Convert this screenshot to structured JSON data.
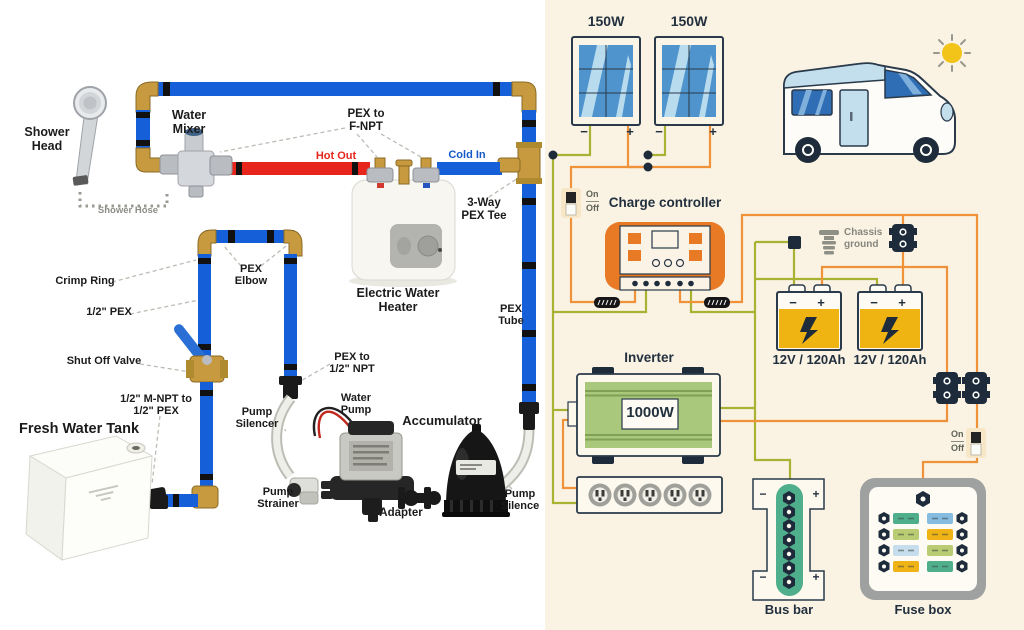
{
  "left": {
    "labels": {
      "shower_head": [
        "Shower",
        "Head"
      ],
      "water_mixer": [
        "Water",
        "Mixer"
      ],
      "shower_hose": "Shower Hose",
      "pex_to_f_npt": [
        "PEX to",
        "F-NPT"
      ],
      "hot_out": "Hot Out",
      "cold_in": "Cold In",
      "three_way_pex_tee": [
        "3-Way",
        "PEX Tee"
      ],
      "crimp_ring": "Crimp Ring",
      "pex_elbow": [
        "PEX",
        "Elbow"
      ],
      "half_inch_pex": "1/2\" PEX",
      "shut_off_valve": "Shut Off Valve",
      "electric_water_heater": [
        "Electric Water",
        "Heater"
      ],
      "pex_tube": [
        "PEX",
        "Tube"
      ],
      "pex_to_half_npt": [
        "PEX to",
        "1/2\" NPT"
      ],
      "m_npt_to_pex": [
        "1/2\" M-NPT to",
        "1/2\" PEX"
      ],
      "fresh_water_tank": "Fresh Water Tank",
      "pump_silencer": [
        "Pump",
        "Silencer"
      ],
      "water_pump": [
        "Water",
        "Pump"
      ],
      "accumulator": "Accumulator",
      "pump_strainer": [
        "Pump",
        "Strainer"
      ],
      "adapter": "Adapter",
      "pump_silence": [
        "Pump",
        "Silence"
      ]
    },
    "colors": {
      "pex_blue": "#1560d8",
      "hot_red": "#e8251d",
      "cold_label_blue": "#1659c8",
      "brass": "#c79a3f"
    }
  },
  "right": {
    "solar_panels": [
      {
        "wattage": "150W"
      },
      {
        "wattage": "150W"
      }
    ],
    "symbols": {
      "minus": "−",
      "plus": "+"
    },
    "switches": [
      {
        "on": "On",
        "off": "Off"
      },
      {
        "on": "On",
        "off": "Off"
      }
    ],
    "charge_controller_label": "Charge controller",
    "chassis_ground": [
      "Chassis",
      "ground"
    ],
    "batteries": [
      {
        "label": "12V / 120Ah"
      },
      {
        "label": "12V / 120Ah"
      }
    ],
    "inverter_label": "Inverter",
    "inverter_power": "1000W",
    "bus_bar_label": "Bus bar",
    "fuse_box_label": "Fuse box",
    "colors": {
      "background": "#faf3e4",
      "wire_positive_orange": "#f0923a",
      "wire_negative_green": "#a9b233",
      "controller_orange": "#e87a25",
      "battery_yellow": "#efb312",
      "inverter_green": "#a9c87c",
      "bus_bar_green": "#4fae8c",
      "outline_navy": "#2a3a4a"
    }
  }
}
